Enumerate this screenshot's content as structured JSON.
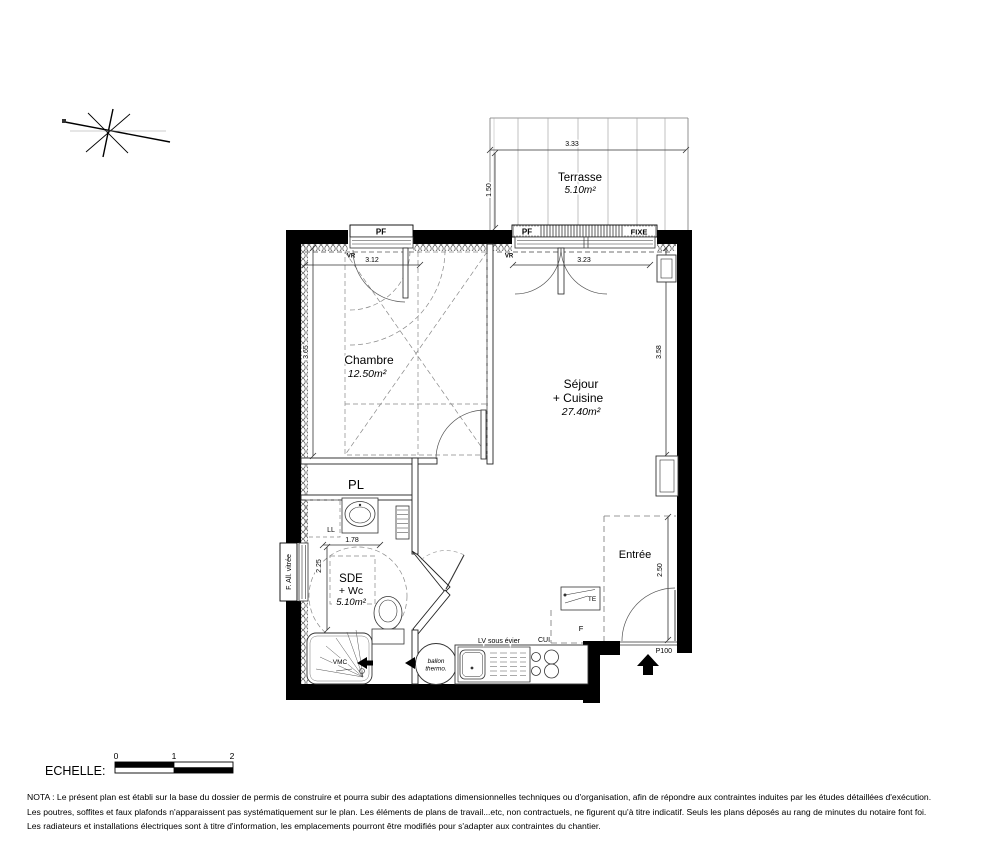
{
  "plan": {
    "terrasse": {
      "name": "Terrasse",
      "area": "5.10m²",
      "dim_width": "3.33",
      "dim_depth": "1.50"
    },
    "chambre": {
      "name": "Chambre",
      "area": "12.50m²",
      "dim_width": "3.12",
      "dim_height": "3.65"
    },
    "sejour": {
      "name_line1": "Séjour",
      "name_line2": "+ Cuisine",
      "area": "27.40m²",
      "dim_width": "3.23",
      "dim_height": "3.58"
    },
    "pl": {
      "name": "PL"
    },
    "sde": {
      "name_line1": "SDE",
      "name_line2": "+ Wc",
      "area": "5.10m²",
      "dim_width": "1.78",
      "dim_height": "2.25"
    },
    "entree": {
      "name": "Entrée",
      "dim_height": "2.50"
    },
    "windows": {
      "pf_left": "PF",
      "pf_right": "PF",
      "fixe": "FIXE",
      "vr_left": "VR",
      "vr_right": "VR",
      "allege": "F. All. vitrée"
    },
    "fixtures": {
      "ll": "LL",
      "vmc": "VMC",
      "ballon_line1": "ballon",
      "ballon_line2": "thermo.",
      "lv_sous_evier": "LV sous évier",
      "cui": "CUI",
      "frigo": "F",
      "te": "TE",
      "porte": "P100"
    }
  },
  "scalebar": {
    "label": "ECHELLE:",
    "tick0": "0",
    "tick1": "1",
    "tick2": "2"
  },
  "nota": {
    "line1": "NOTA : Le présent plan est établi sur la base du dossier de permis de construire et pourra subir des adaptations dimensionnelles techniques ou d'organisation, afin de répondre aux contraintes induites par les études détaillées d'exécution.",
    "line2": "Les poutres, soffites et faux plafonds n'apparaissent pas systématiquement sur le plan. Les éléments de plans de travail...etc, non contractuels, ne figurent qu'à titre indicatif. Seuls les plans déposés au rang de minutes du notaire font foi.",
    "line3": "Les radiateurs et installations électriques sont à titre d'information, les emplacements pourront être modifiés pour s'adapter aux contraintes du chantier."
  },
  "colors": {
    "wall": "#000000",
    "line": "#333333",
    "dash": "#888888"
  }
}
